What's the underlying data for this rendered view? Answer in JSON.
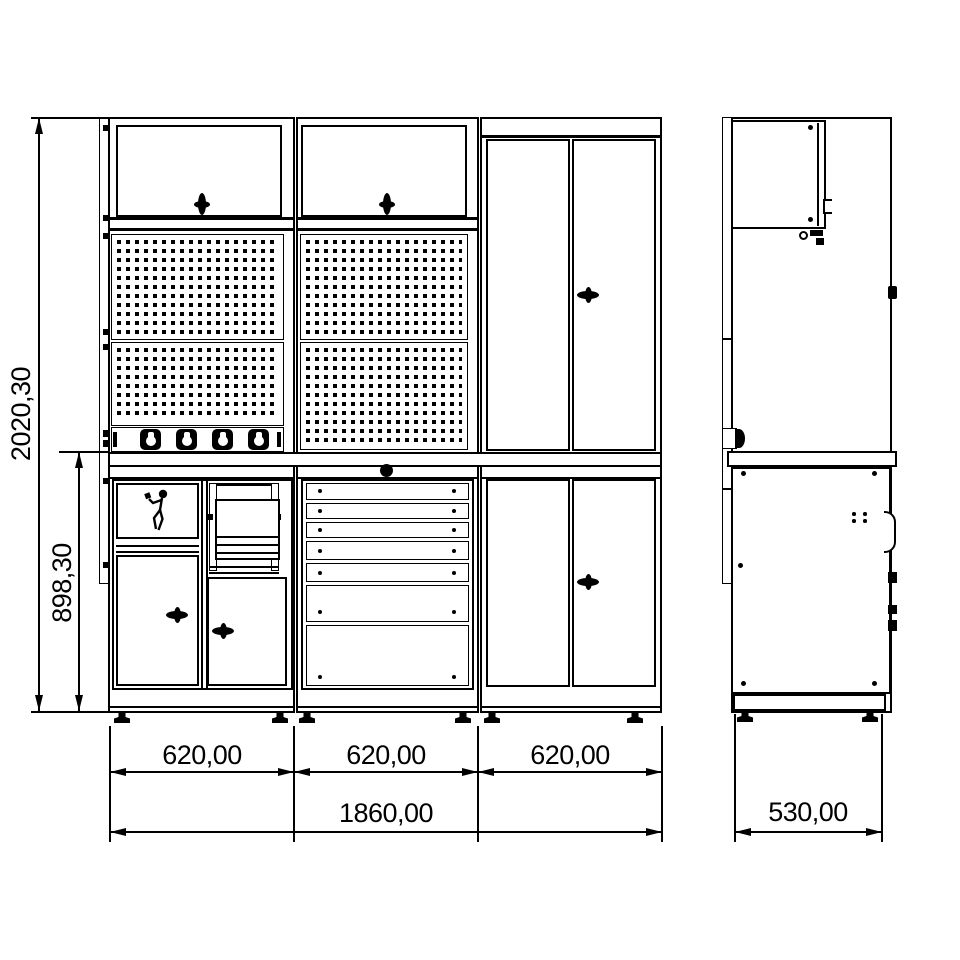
{
  "drawing": {
    "type": "technical-drawing",
    "subject": "modular workshop cabinet system, front and side elevation",
    "line_color": "#000000",
    "background": "#ffffff"
  },
  "dimensions": {
    "overall_height": "2020,30",
    "bench_height": "898,30",
    "module_widths": [
      "620,00",
      "620,00",
      "620,00"
    ],
    "total_width": "1860,00",
    "depth": "530,00"
  },
  "icons": {
    "tidyman": "waste-disposal-person",
    "door_handle": "wing-knob",
    "power_socket": "schuko-socket",
    "grommet": "cable-grommet",
    "leveling_foot": "adjustable-foot"
  }
}
